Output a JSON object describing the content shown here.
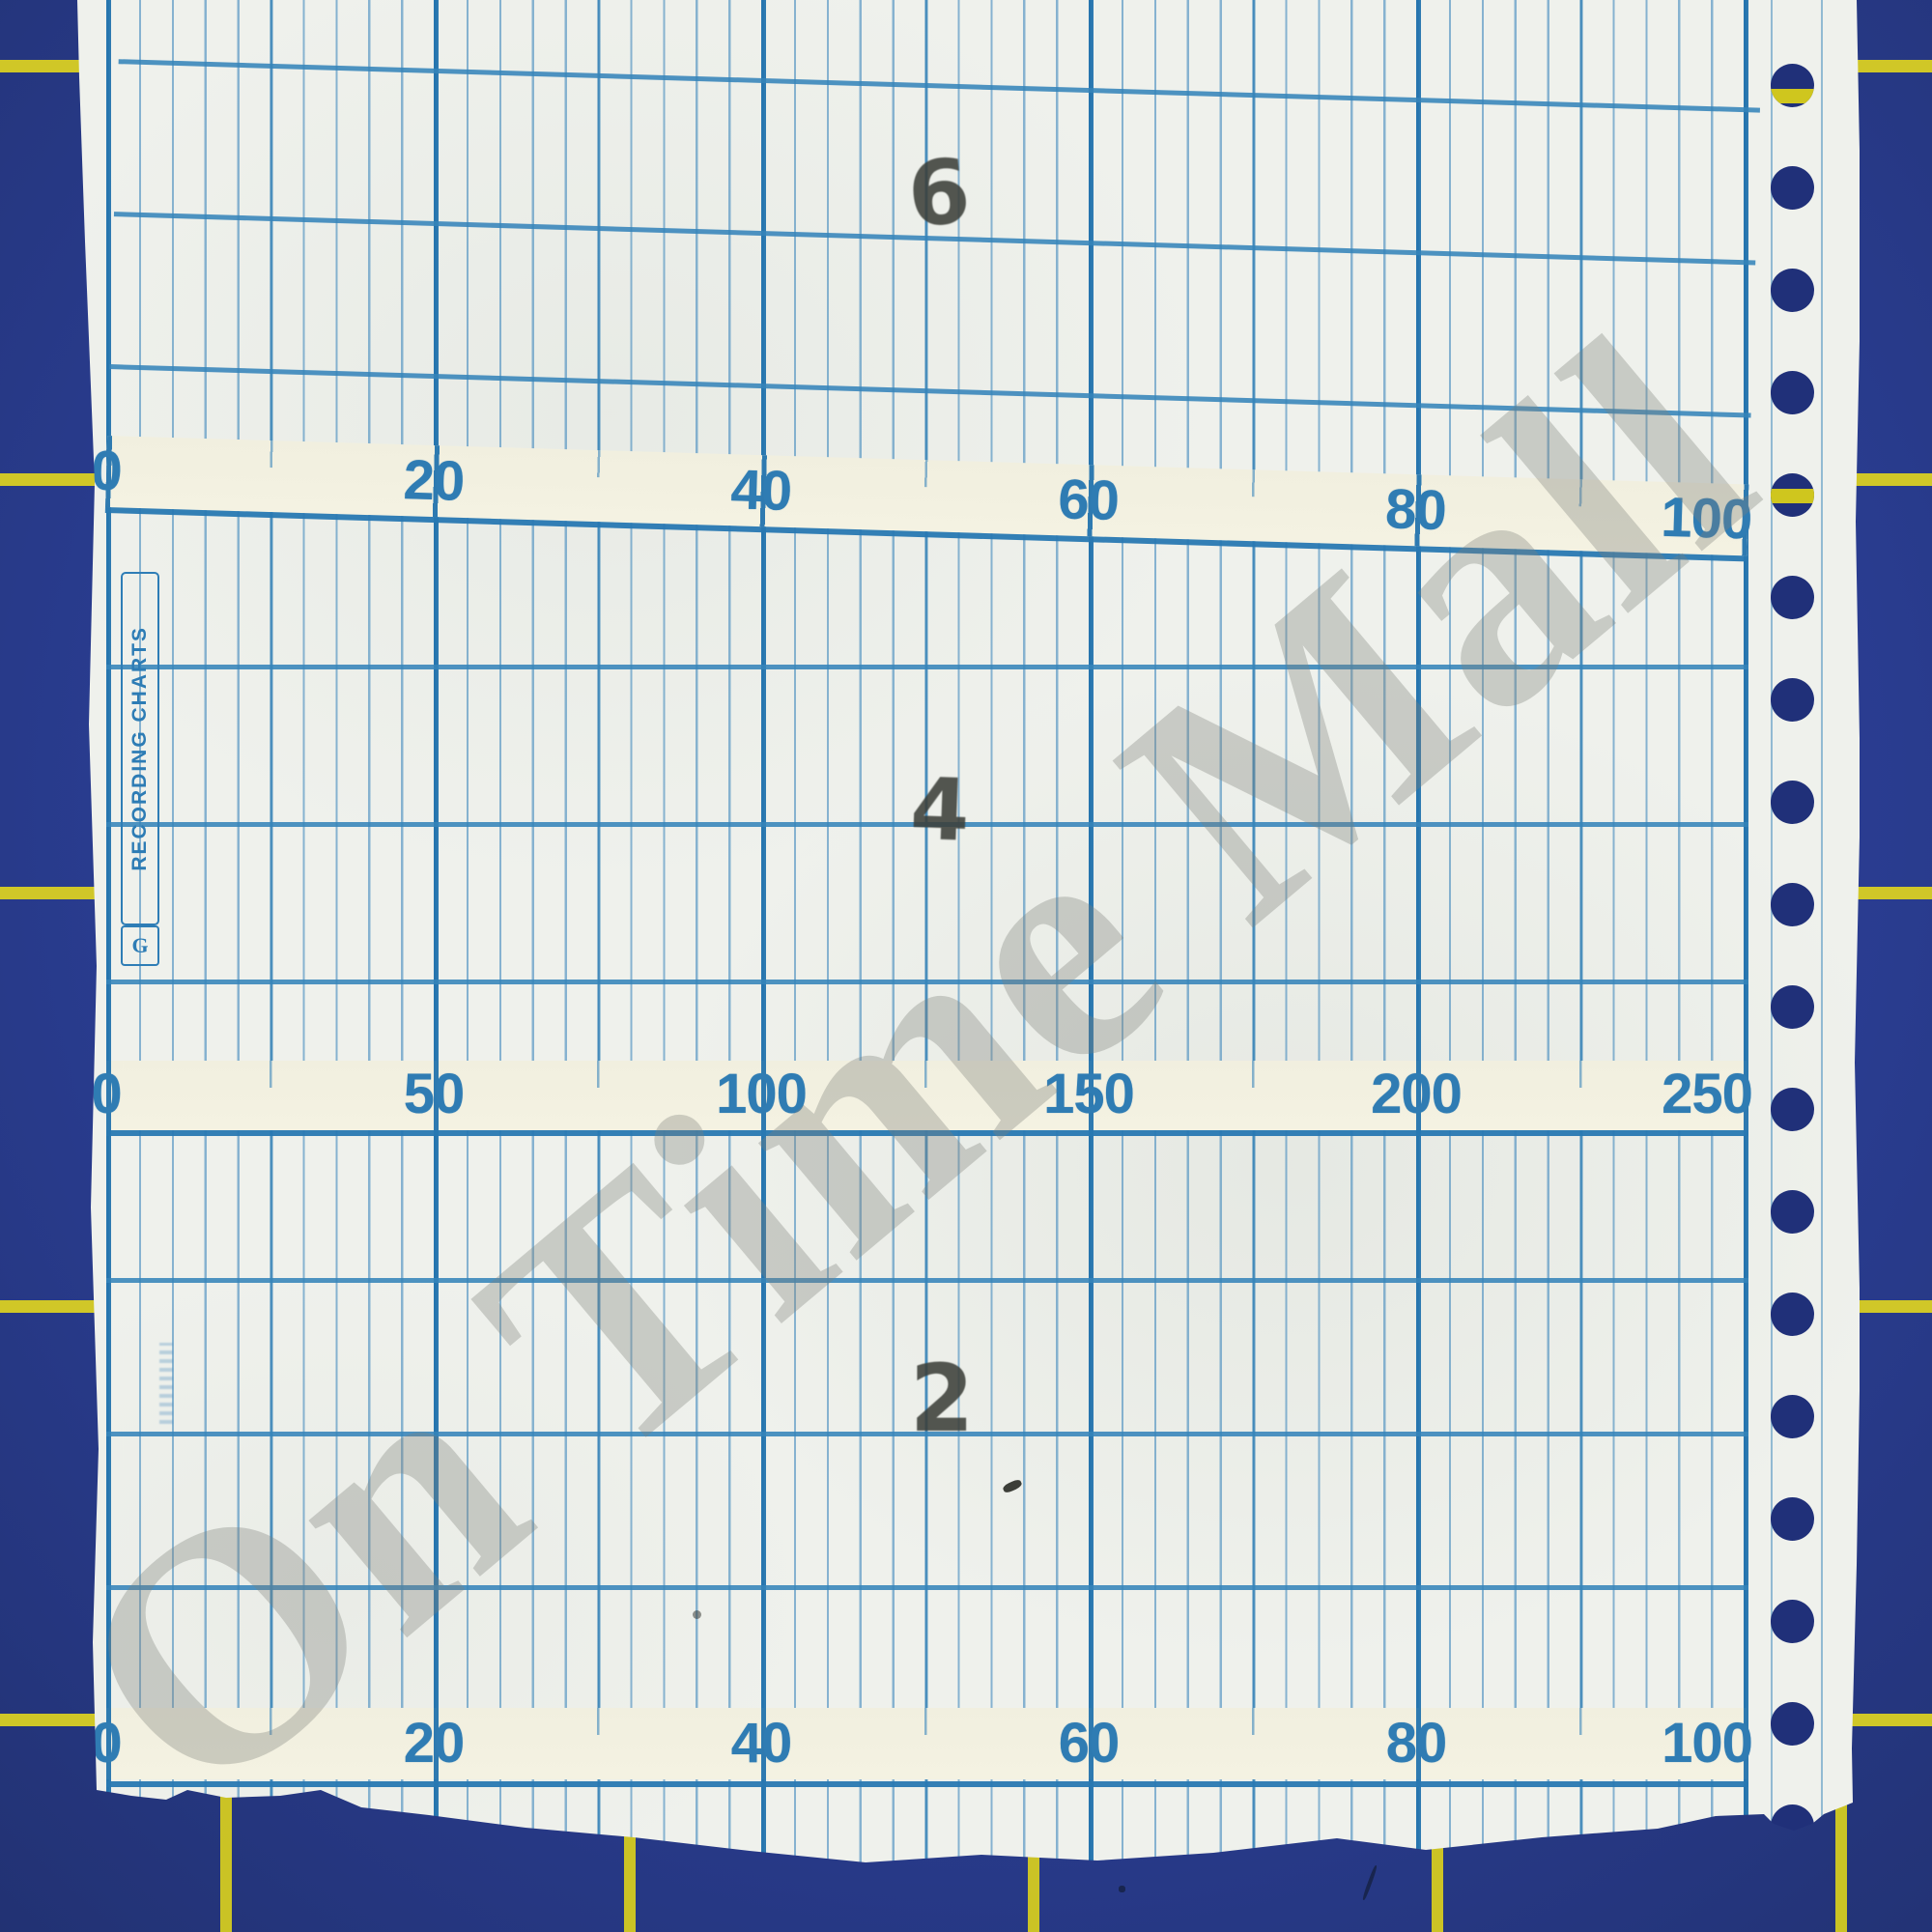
{
  "watermark": {
    "text": "On Time Mall"
  },
  "paper": {
    "brand_label": "RECORDING CHARTS",
    "logo_monogram": "G",
    "page_stamps": [
      "6",
      "4",
      "2"
    ],
    "scales": {
      "row1": {
        "values": [
          "0",
          "20",
          "40",
          "60",
          "80",
          "100"
        ]
      },
      "row2": {
        "values": [
          "0",
          "50",
          "100",
          "150",
          "200",
          "250"
        ]
      },
      "row3": {
        "values": [
          "0",
          "20",
          "40",
          "60",
          "80",
          "100"
        ]
      }
    }
  },
  "colors": {
    "mat_blue": "#2a3d92",
    "mat_grid_yellow": "#ded41f",
    "paper_white": "#eff1ec",
    "band_cream": "#f2f0e0",
    "grid_fine_blue": "#4a8fc2",
    "grid_major_blue": "#2474ae",
    "scale_number_blue": "#2f7cb3",
    "stamp_gray": "#3d403a",
    "hole_shadow_blue": "#203079",
    "watermark_gray": "#82857f"
  }
}
